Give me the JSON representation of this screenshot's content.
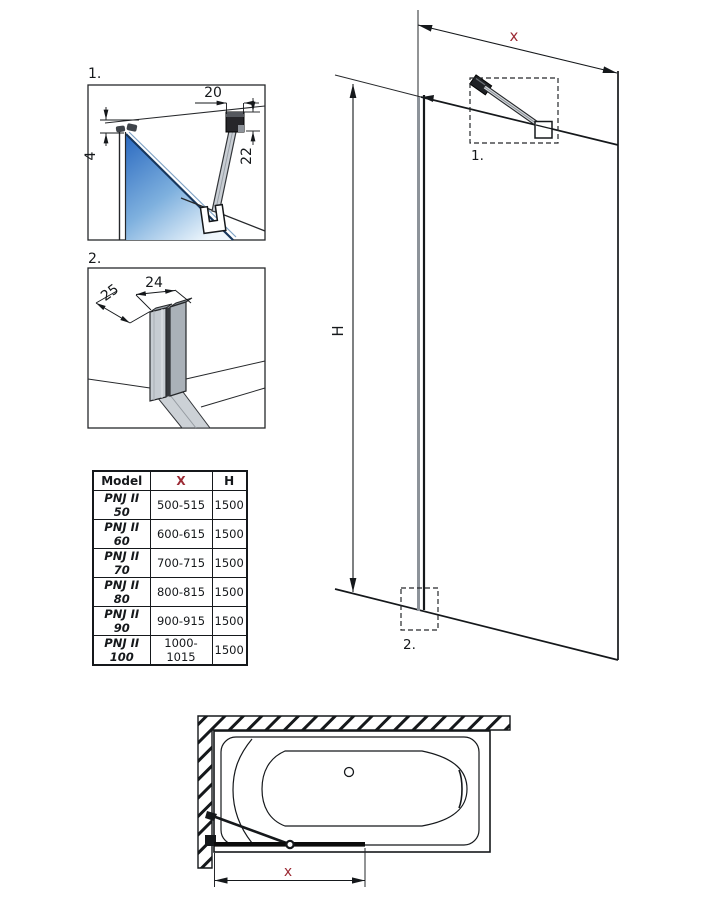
{
  "colors": {
    "accent": "#9c2b35",
    "line": "#15181b"
  },
  "detail1": {
    "label": "1.",
    "dim_top": "20",
    "dim_left": "4",
    "dim_right": "22"
  },
  "detail2": {
    "label": "2.",
    "dim_width": "24",
    "dim_depth": "25"
  },
  "elevation": {
    "dim_width": "x",
    "dim_height": "H",
    "callout1": "1.",
    "callout2": "2."
  },
  "plan": {
    "dim_width": "x"
  },
  "table": {
    "headers": {
      "model": "Model",
      "x": "X",
      "h": "H"
    },
    "rows": [
      {
        "model": "PNJ II 50",
        "x": "500-515",
        "h": "1500"
      },
      {
        "model": "PNJ II 60",
        "x": "600-615",
        "h": "1500"
      },
      {
        "model": "PNJ II 70",
        "x": "700-715",
        "h": "1500"
      },
      {
        "model": "PNJ II 80",
        "x": "800-815",
        "h": "1500"
      },
      {
        "model": "PNJ II 90",
        "x": "900-915",
        "h": "1500"
      },
      {
        "model": "PNJ II 100",
        "x": "1000-1015",
        "h": "1500"
      }
    ]
  }
}
